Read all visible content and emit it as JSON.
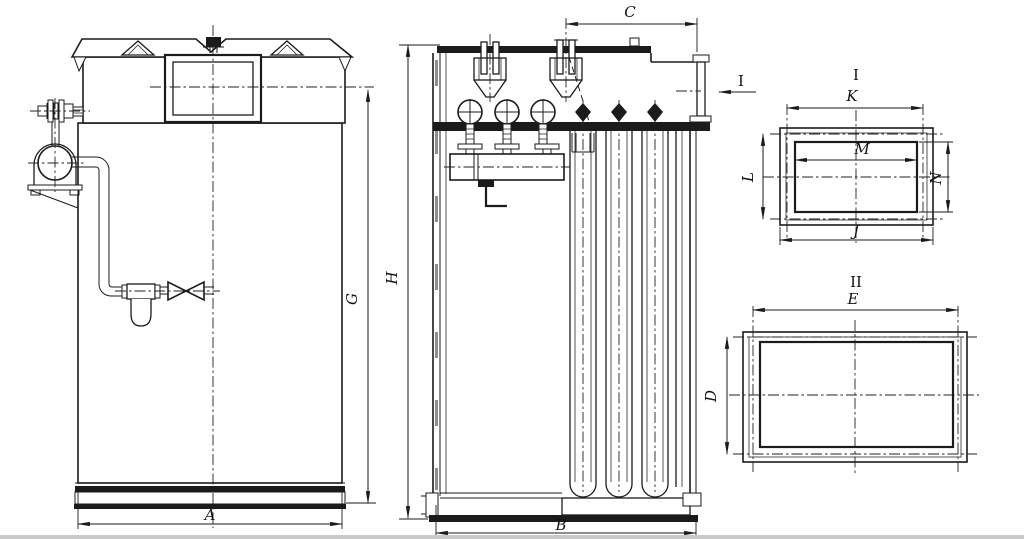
{
  "drawing": {
    "title": "Pulse-jet bag filter dust collector - dimensional outline drawing",
    "type": "technical-drawing",
    "colors": {
      "line": "#1b1b1b",
      "background": "#ffffff",
      "scan_edge": "#c9c9c9"
    },
    "views": {
      "front_view": {
        "description": "front elevation with compressed-air tank, filter-regulator and shutoff valve piping",
        "width_dim": "A",
        "height_dim": "G"
      },
      "side_view": {
        "description": "sectioned side elevation showing pulse valves, manifold and filter bags",
        "width_dim": "B",
        "height_dim": "H",
        "top_dim": "C",
        "flange_callout": "I"
      },
      "detail_1": {
        "title": "I",
        "description": "clean-air outlet flange",
        "bolt_span_width": "K",
        "opening_width": "M",
        "bolt_span_height": "L",
        "opening_height": "N",
        "outer_width": "J"
      },
      "detail_2": {
        "title": "II",
        "description": "dirty-air inlet flange",
        "width_dim": "E",
        "height_dim": "D"
      }
    },
    "labels": {
      "A": "A",
      "B": "B",
      "C": "C",
      "D": "D",
      "E": "E",
      "G": "G",
      "H": "H",
      "J": "J",
      "K": "K",
      "L": "L",
      "M": "M",
      "N": "N",
      "callout_I": "I",
      "view1_title": "I",
      "view2_title": "II"
    }
  }
}
